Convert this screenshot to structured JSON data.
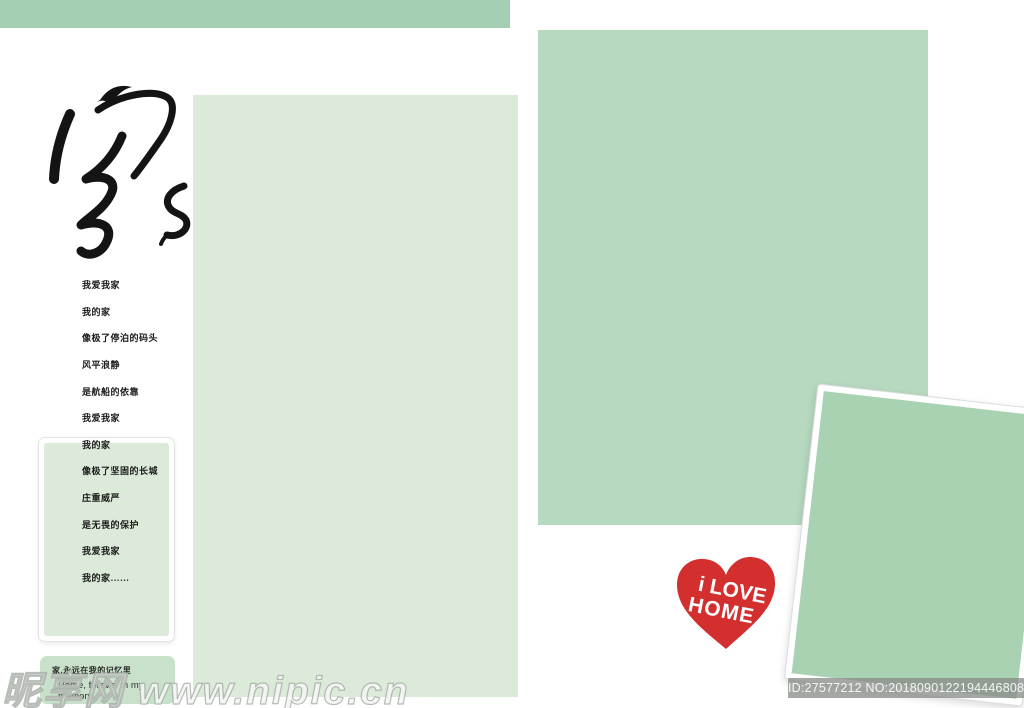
{
  "page": {
    "title_character": "家"
  },
  "poem": {
    "lines": [
      "我爱我家",
      "我的家",
      "像极了停泊的码头",
      "风平浪静",
      "是航船的依靠",
      "我爱我家",
      "我的家",
      "像极了坚固的长城",
      "庄重威严",
      "是无畏的保护",
      "我爱我家",
      "我的家……"
    ]
  },
  "caption_box": {
    "line1_zh": "家,永远在我的记忆里",
    "line2_en": "Home, forever in my memory"
  },
  "heart": {
    "line1": "i LOVE",
    "line2": "HOME",
    "color": "#d32f2f"
  },
  "watermark": {
    "site_text": "昵享网 www.nipic.cn",
    "id_text": "ID:27577212 NO:20180901221944468084"
  },
  "colors": {
    "header_bar": "#a5cfb2",
    "photo_left_placeholder": "#dcead9",
    "photo_right_placeholder": "#b7d9c0",
    "photo_tilted_placeholder": "#a9d2b3",
    "caption_box": "#c9e1ca",
    "heart_red": "#d32f2f"
  }
}
